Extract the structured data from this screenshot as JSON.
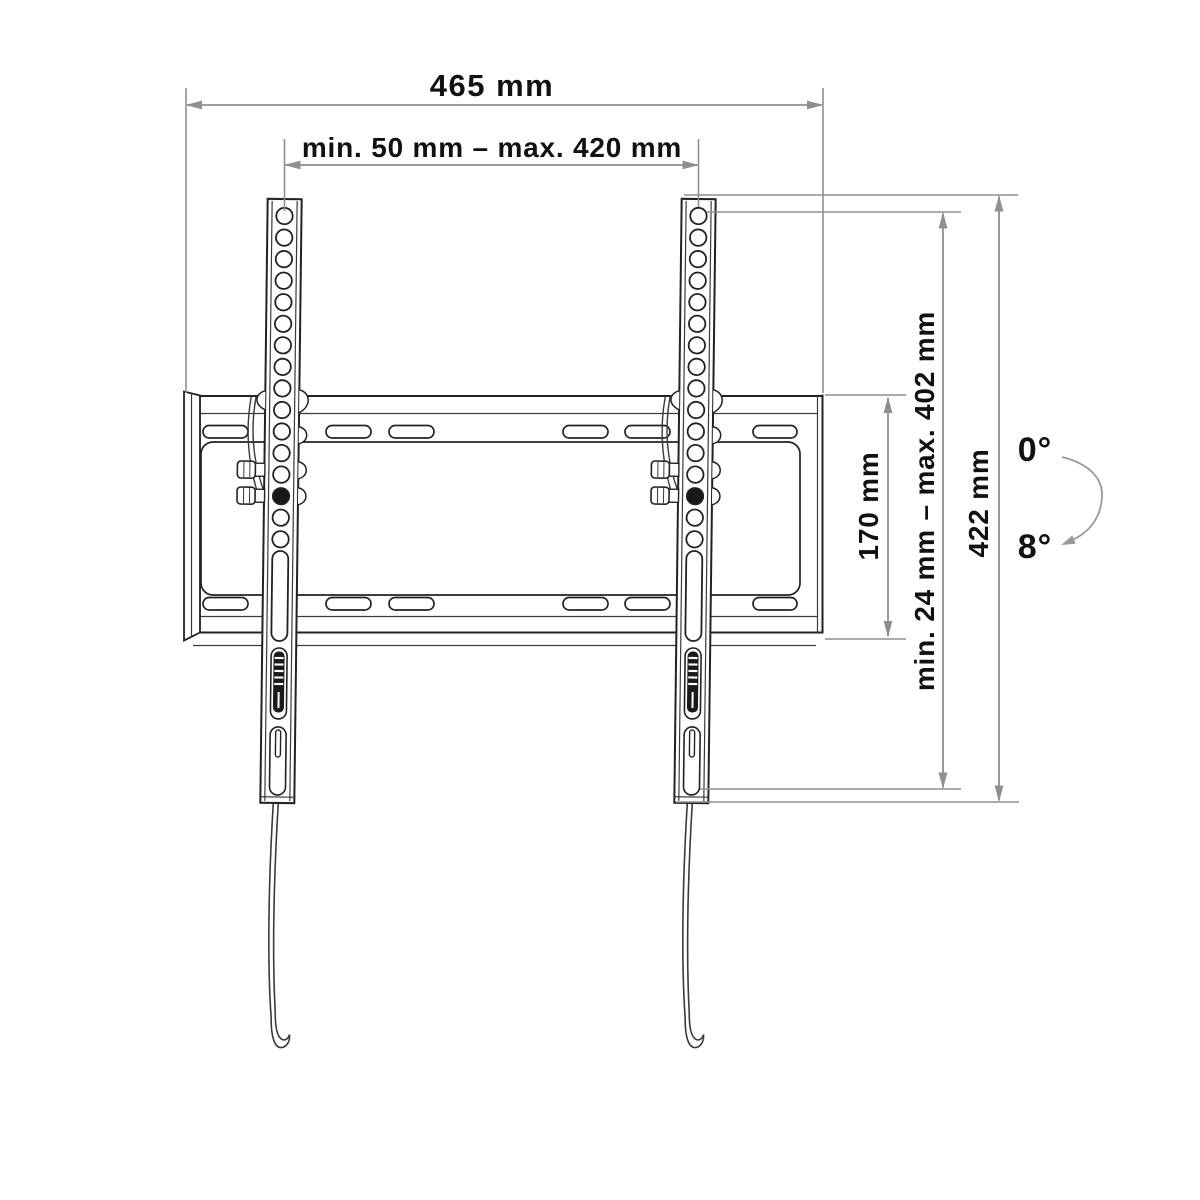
{
  "diagram": {
    "kind": "tv-wall-mount-dimension-drawing",
    "dimensions": {
      "total_width": {
        "label": "465 mm",
        "value_mm": 465
      },
      "horizontal_range": {
        "label": "min. 50 mm – max. 420 mm",
        "min_mm": 50,
        "max_mm": 420
      },
      "plate_height": {
        "label": "170 mm",
        "value_mm": 170
      },
      "vertical_range": {
        "label": "min. 24 mm – max. 402 mm",
        "min_mm": 24,
        "max_mm": 402
      },
      "rail_height": {
        "label": "422 mm",
        "value_mm": 422
      }
    },
    "tilt": {
      "min": {
        "label": "0°",
        "deg": 0
      },
      "max": {
        "label": "8°",
        "deg": 8
      }
    },
    "colors": {
      "outline": "#222222",
      "detail_line": "#3a3a3a",
      "dimension_line": "#8f8f8f",
      "text": "#111111",
      "background": "#ffffff"
    }
  }
}
